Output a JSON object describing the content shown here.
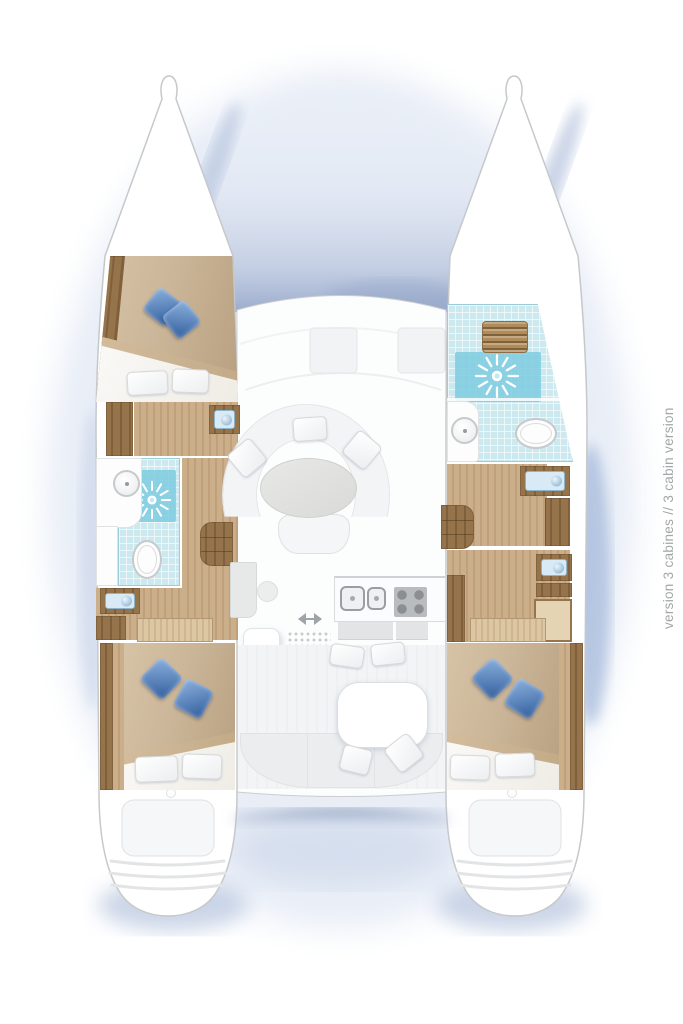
{
  "caption": {
    "text": "version 3 cabines // 3 cabin version"
  },
  "palette": {
    "text_gray": "#a3a6a9",
    "hull_outline": "#c6c8ca",
    "wood_dark": "#96744b",
    "wood_dark_stripe": "#805f3b",
    "wood_floor": "#cbae8a",
    "wood_floor_stripe": "#bfa07a",
    "teak_grate": "#b08c5c",
    "bed_tan": "#cbb699",
    "bed_tan_dark": "#b89f80",
    "pillow_blue_light": "#8cb1dc",
    "pillow_blue_dark": "#2f5c9c",
    "tile_blue": "#cde9f0",
    "shower_blue": "#7ecbe0",
    "fixture_outline": "#c7c9cb",
    "sofa_white": "#f3f4f6",
    "counter_gray": "#e2e4e5",
    "shadow_blue": "#a9bad8"
  },
  "icons": {
    "shower_drain": "white radial starburst on blue tile",
    "washbasin_round": "circle with center drain dot",
    "washbasin_rect": "light blue basin with round bowl",
    "toilet": "white oval bowl with rim",
    "stove": "gray square with 4 burner circles",
    "sink_double": "two outlined rounded squares",
    "sliding_door_arrow": "double headed left-right arrow",
    "teak_grate": "slatted wooden shower grate"
  }
}
